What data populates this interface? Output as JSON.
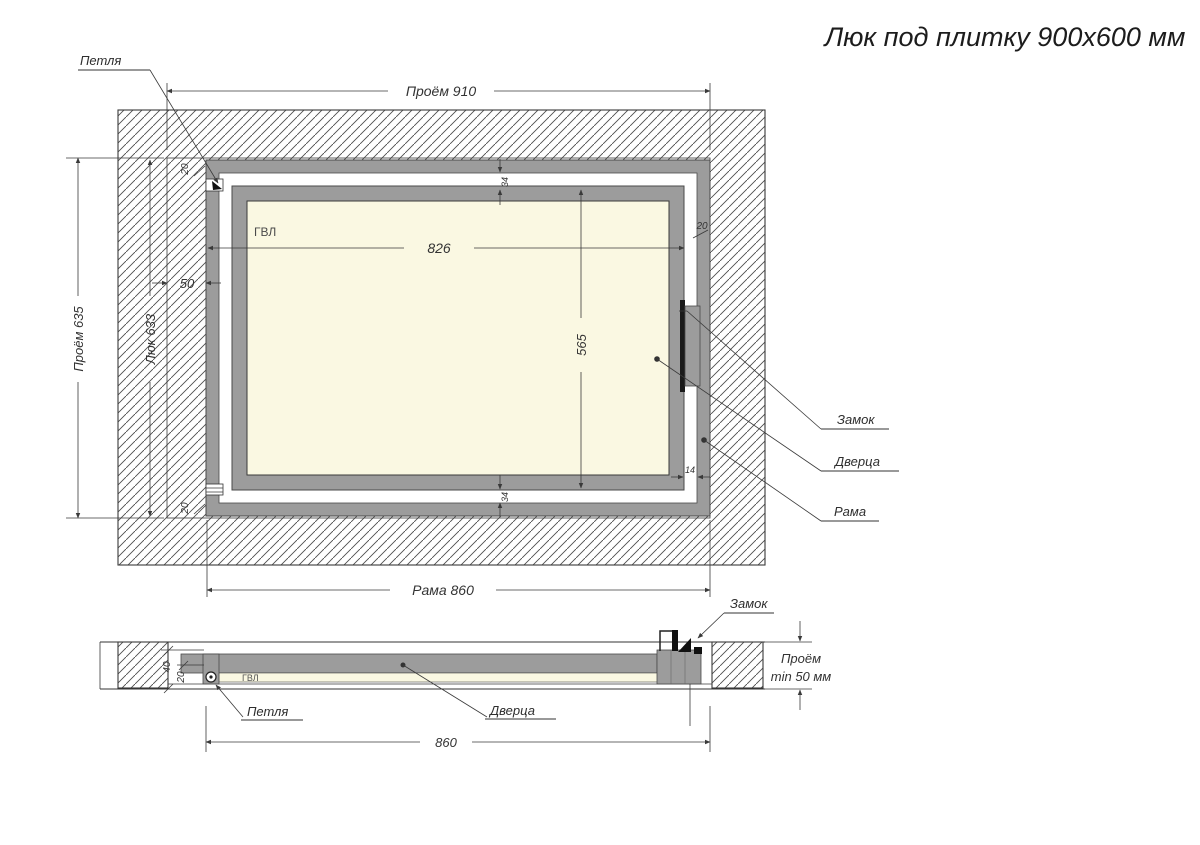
{
  "title": "Люк под плитку 900х600 мм",
  "colors": {
    "frame_gray": "#9c9c9c",
    "panel_cream": "#faf8e2",
    "line_dark": "#333333",
    "background": "#ffffff"
  },
  "front_view": {
    "label_hinge": "Петля",
    "label_lock": "Замок",
    "label_door": "Дверца",
    "label_frame": "Рама",
    "label_gvl": "ГВЛ",
    "dim_opening_width": "Проём 910",
    "dim_opening_height": "Проём 635",
    "dim_hatch_height": "Люк 633",
    "dim_side_gap": "50",
    "dim_frame_20_top_left": "20",
    "dim_frame_20_bottom_left": "20",
    "dim_frame_20_right": "20",
    "dim_door_width": "826",
    "dim_door_height": "565",
    "dim_gap_top": "34",
    "dim_gap_bottom": "34",
    "dim_gap_right": "14",
    "dim_frame_width": "Рама 860"
  },
  "section_view": {
    "label_lock": "Замок",
    "label_hinge": "Петля",
    "label_door": "Дверца",
    "label_gvl": "ГВЛ",
    "dim_depth_total": "40",
    "dim_depth_frame": "20",
    "dim_width": "860",
    "dim_clearance_line1": "Проём",
    "dim_clearance_line2": "min 50 мм"
  }
}
